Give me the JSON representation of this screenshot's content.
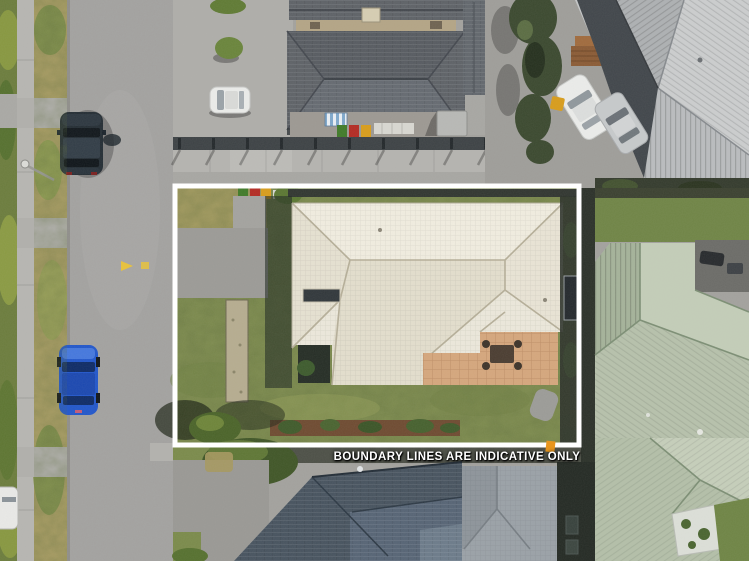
{
  "overlay": {
    "disclaimer_text": "BOUNDARY LINES ARE INDICATIVE ONLY"
  },
  "palette": {
    "boundary-line": "#ffffff",
    "disclaimer": "#ffffff",
    "road": "#a3a2a0",
    "sidewalk": "#b6b5b1",
    "berm-dry": "#a89c62",
    "lawn": "#7e8c4e",
    "hedge": "#6b7c3c",
    "subject-roof": "#ece8db",
    "dark-roof": "#5d6166",
    "metal-roof": "#c4c6c7",
    "sage-roof": "#b3bfa8",
    "navy-roof": "#46525e",
    "gray-tile-roof": "#9aa1a7",
    "patio": "#d5a67c",
    "blue-car": "#2156cb",
    "dark-car": "#232c33",
    "white-car": "#ebecea",
    "bin-green": "#3f7a28",
    "bin-red": "#b32a22",
    "bin-yellow": "#d89c1a",
    "road-marking": "#e8c23a",
    "orange-marker": "#e8961e"
  }
}
